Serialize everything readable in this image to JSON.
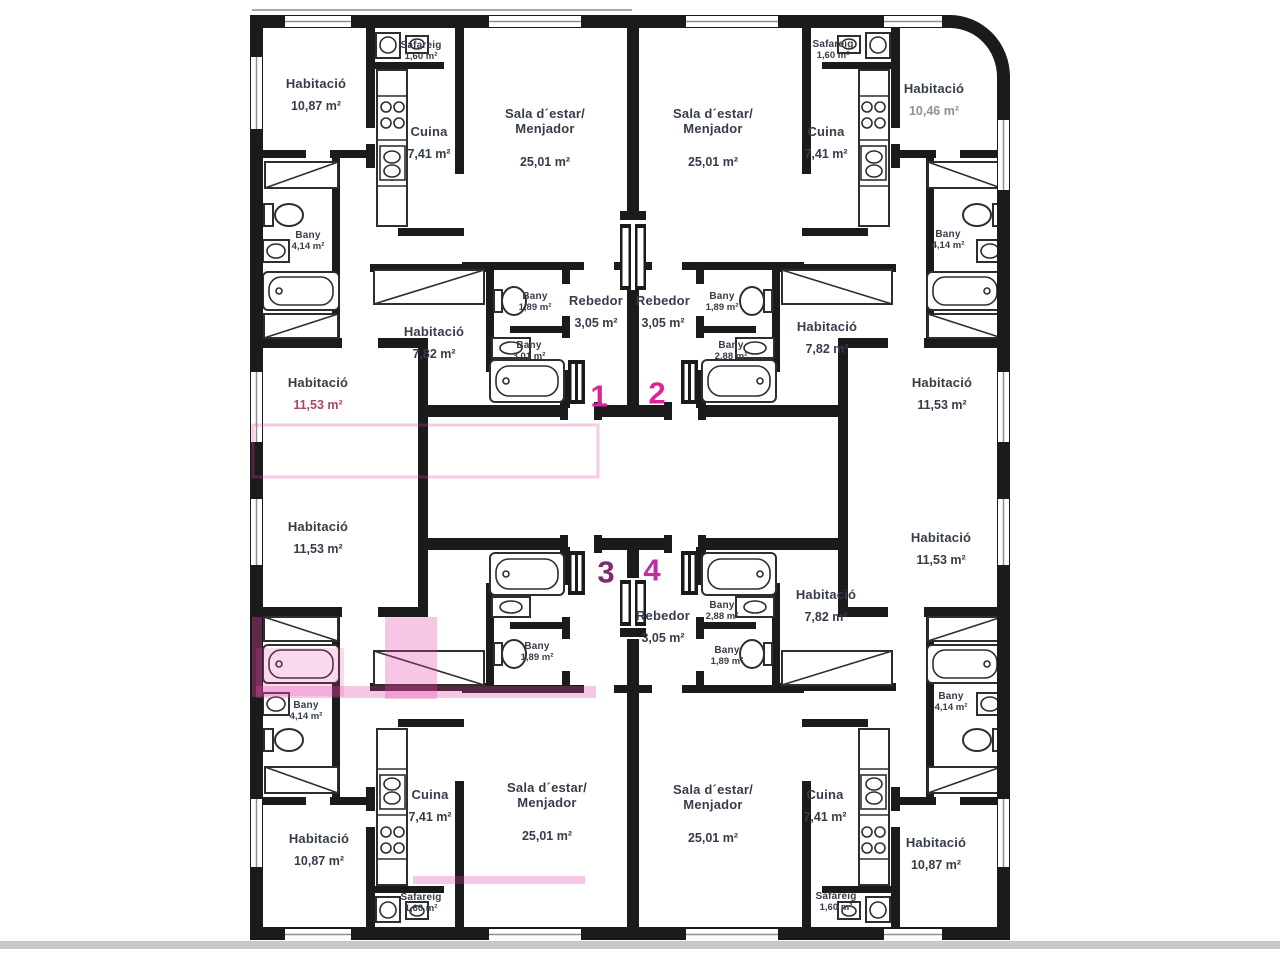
{
  "colors": {
    "wall": "#1b1b1b",
    "label_text": "#363d4a",
    "unit_number_pink": "#e0219e",
    "unit_number_purple": "#7e2a72",
    "watermark_pink": "#e146a5",
    "faded_area_red": "#a8495f"
  },
  "units": [
    {
      "number": "1",
      "style": "color:#e0219e"
    },
    {
      "number": "2",
      "style": "color:#e0219e"
    },
    {
      "number": "3",
      "style": "color:#7e2a72"
    },
    {
      "number": "4",
      "style": "color:#c32da4"
    }
  ],
  "rooms": [
    {
      "name": "Habitació",
      "area": "10,87 m²"
    },
    {
      "name": "Safareig",
      "area": "1,60 m²"
    },
    {
      "name": "Cuina",
      "area": "7,41 m²"
    },
    {
      "name": "Sala d´estar/",
      "name2": "Menjador",
      "area": "25,01 m²"
    },
    {
      "name": "Bany",
      "area": "4,14 m²"
    },
    {
      "name": "Habitació",
      "area": "11,53 m²",
      "area_style": "color:#a8495f"
    },
    {
      "name": "Habitació",
      "area": "7,82 m²"
    },
    {
      "name": "Bany",
      "area": "1,89 m²"
    },
    {
      "name": "Bany",
      "area": "3,01 m²"
    },
    {
      "name": "Rebedor",
      "area": "3,05 m²"
    },
    {
      "name": "Sala d´estar/",
      "name2": "Menjador",
      "area": "25,01 m²"
    },
    {
      "name": "Safareig",
      "area": "1,60 m²"
    },
    {
      "name": "Cuina",
      "area": "7,41 m²"
    },
    {
      "name": "Habitació",
      "area": "10,46 m²",
      "area_style": "color:#8f8f9c"
    },
    {
      "name": "Bany",
      "area": "4,14 m²"
    },
    {
      "name": "Rebedor",
      "area": "3,05 m²"
    },
    {
      "name": "Bany",
      "area": "1,89 m²"
    },
    {
      "name": "Bany",
      "area": "2,88 m²"
    },
    {
      "name": "Habitació",
      "area": "7,82 m²"
    },
    {
      "name": "Habitació",
      "area": "11,53 m²"
    },
    {
      "name": "Habitació",
      "area": "11,53 m²"
    },
    {
      "name": "Bany",
      "area": "4,14 m²"
    },
    {
      "name": "Habitació",
      "area": "10,87 m²"
    },
    {
      "name": "Cuina",
      "area": "7,41 m²"
    },
    {
      "name": "Safareig",
      "area": "1,60 m²"
    },
    {
      "name": "Sala d´estar/",
      "name2": "Menjador",
      "area": "25,01 m²"
    },
    {
      "name": "Bany",
      "area": "1,89 m²"
    },
    {
      "name": "Rebedor",
      "area": "3,05 m²"
    },
    {
      "name": "Bany",
      "area": "2,88 m²"
    },
    {
      "name": "Bany",
      "area": "1,89 m²"
    },
    {
      "name": "Habitació",
      "area": "7,82 m²"
    },
    {
      "name": "Habitació",
      "area": "11,53 m²"
    },
    {
      "name": "Bany",
      "area": "4,14 m²"
    },
    {
      "name": "Habitació",
      "area": "10,87 m²"
    },
    {
      "name": "Cuina",
      "area": "7,41 m²"
    },
    {
      "name": "Safareig",
      "area": "1,60 m²"
    },
    {
      "name": "Sala d´estar/",
      "name2": "Menjador",
      "area": "25,01 m²"
    }
  ]
}
